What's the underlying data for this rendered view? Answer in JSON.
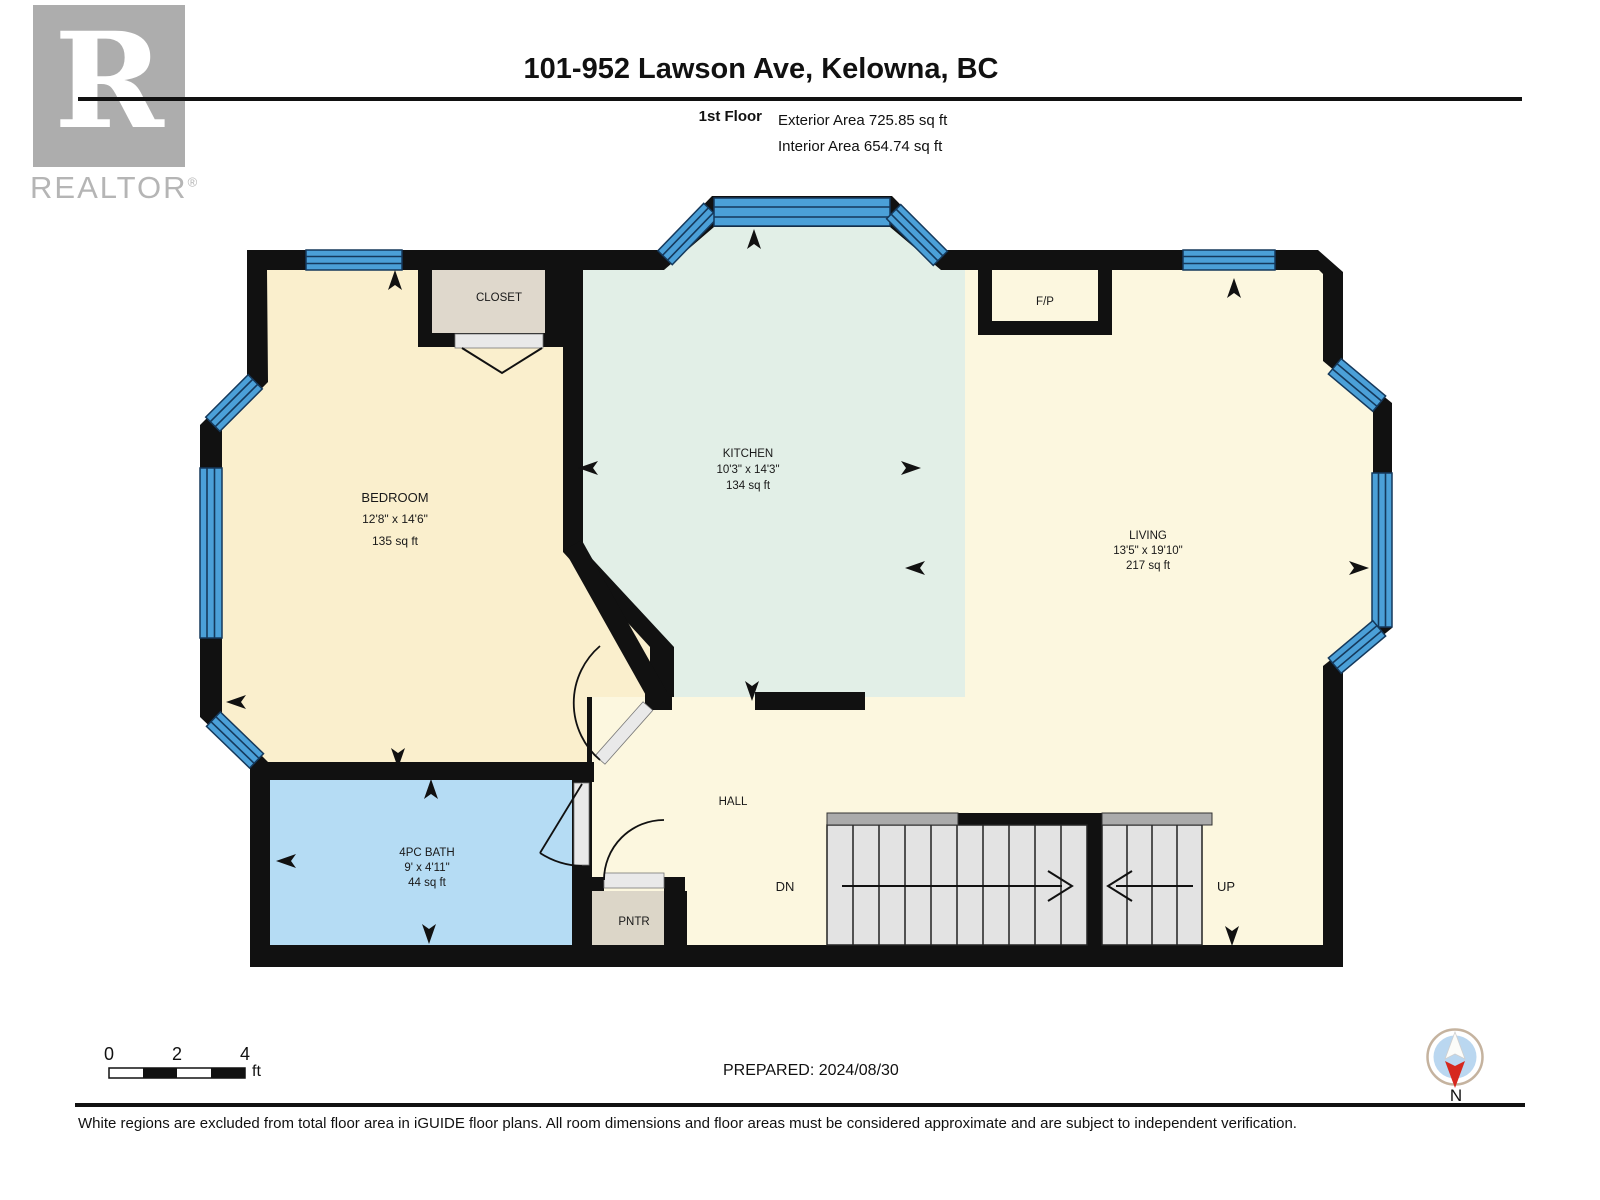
{
  "header": {
    "logo_letter": "R",
    "logo_brand": "REALTOR",
    "logo_reg": "®",
    "title": "101-952 Lawson Ave, Kelowna, BC",
    "floor_label": "1st Floor",
    "exterior_area": "Exterior Area 725.85 sq ft",
    "interior_area": "Interior Area 654.74 sq ft"
  },
  "plan": {
    "rooms": {
      "bedroom": {
        "name": "BEDROOM",
        "dims": "12'8\" x 14'6\"",
        "area": "135 sq ft"
      },
      "kitchen": {
        "name": "KITCHEN",
        "dims": "10'3\" x 14'3\"",
        "area": "134 sq ft"
      },
      "living": {
        "name": "LIVING",
        "dims": "13'5\" x 19'10\"",
        "area": "217 sq ft"
      },
      "bath": {
        "name": "4PC BATH",
        "dims": "9' x 4'11\"",
        "area": "44 sq ft"
      },
      "closet": {
        "name": "CLOSET"
      },
      "hall": {
        "name": "HALL"
      },
      "pantry": {
        "name": "PNTR"
      },
      "fireplace": {
        "name": "F/P"
      }
    },
    "stairs": {
      "down": "DN",
      "up": "UP"
    }
  },
  "legend": {
    "scale_ticks": [
      "0",
      "2",
      "4"
    ],
    "scale_unit": "ft",
    "prepared": "PREPARED: 2024/08/30",
    "compass_label": "N"
  },
  "footer": {
    "disclaimer": "White regions are excluded from total floor area in iGUIDE floor plans. All room dimensions and floor areas must be considered approximate and are subject to independent verification."
  },
  "colors": {
    "wall": "#111111",
    "bedroom": "#FAEFCD",
    "kitchen": "#E2EFE7",
    "living": "#FCF7DF",
    "bath": "#B5DCF4",
    "closet": "#DFD8CC",
    "window": "#4BA0D8",
    "stair": "#E3E3E3",
    "compass_red": "#D6281E"
  }
}
